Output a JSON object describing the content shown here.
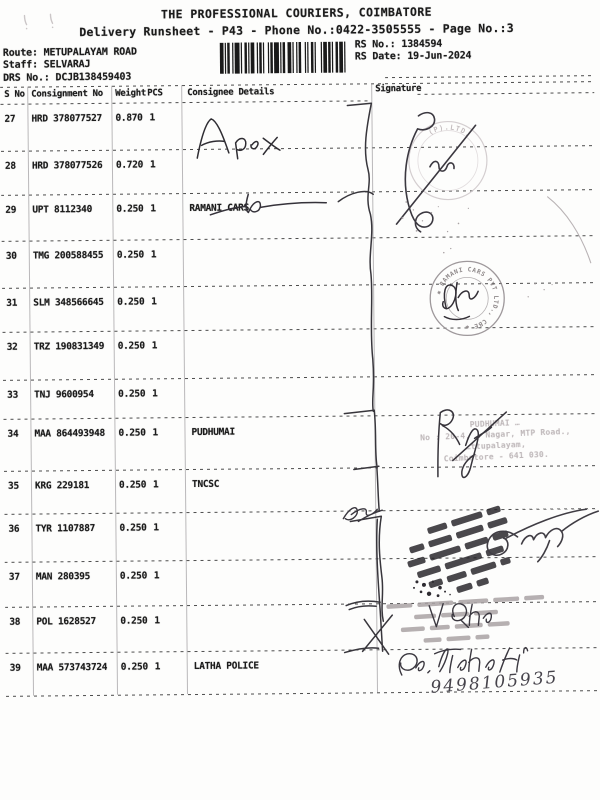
{
  "doc": {
    "title": "THE PROFESSIONAL COURIERS, COIMBATORE",
    "subtitle": "Delivery Runsheet - P43 - Phone No.:0422-3505555 - Page No.:3",
    "route_label": "Route:",
    "route_value": "METUPALAYAM ROAD",
    "staff_label": "Staff:",
    "staff_value": "SELVARAJ",
    "drs_label": "DRS No.:",
    "drs_value": "DCJB138459403",
    "rs_no_label": "RS No.:",
    "rs_no_value": "1384594",
    "rs_date_label": "RS Date:",
    "rs_date_value": "19-Jun-2024"
  },
  "table": {
    "headers": {
      "sno": "S No",
      "consignment": "Consignment No",
      "weight": "Weight",
      "pcs": "PCS",
      "consignee": "Consignee Details",
      "signature": "Signature"
    },
    "rows": [
      {
        "sno": "27",
        "consignment": "HRD 378077527",
        "weight": "0.870",
        "pcs": "1",
        "consignee": ""
      },
      {
        "sno": "28",
        "consignment": "HRD 378077526",
        "weight": "0.720",
        "pcs": "1",
        "consignee": ""
      },
      {
        "sno": "29",
        "consignment": "UPT 8112340",
        "weight": "0.250",
        "pcs": "1",
        "consignee": "RAMANI CARS"
      },
      {
        "sno": "30",
        "consignment": "TMG 200588455",
        "weight": "0.250",
        "pcs": "1",
        "consignee": ""
      },
      {
        "sno": "31",
        "consignment": "SLM 348566645",
        "weight": "0.250",
        "pcs": "1",
        "consignee": ""
      },
      {
        "sno": "32",
        "consignment": "TRZ 190831349",
        "weight": "0.250",
        "pcs": "1",
        "consignee": ""
      },
      {
        "sno": "33",
        "consignment": "TNJ 9600954",
        "weight": "0.250",
        "pcs": "1",
        "consignee": ""
      },
      {
        "sno": "34",
        "consignment": "MAA 864493948",
        "weight": "0.250",
        "pcs": "1",
        "consignee": "PUDHUMAI"
      },
      {
        "sno": "35",
        "consignment": "KRG 229181",
        "weight": "0.250",
        "pcs": "1",
        "consignee": "TNCSC"
      },
      {
        "sno": "36",
        "consignment": "TYR 1107887",
        "weight": "0.250",
        "pcs": "1",
        "consignee": ""
      },
      {
        "sno": "37",
        "consignment": "MAN 280395",
        "weight": "0.250",
        "pcs": "1",
        "consignee": ""
      },
      {
        "sno": "38",
        "consignment": "POL 1628527",
        "weight": "0.250",
        "pcs": "1",
        "consignee": ""
      },
      {
        "sno": "39",
        "consignment": "MAA 573743724",
        "weight": "0.250",
        "pcs": "1",
        "consignee": "LATHA POLICE"
      }
    ]
  },
  "stamps": {
    "courier_arc": "(P).LTD.",
    "ramani_arc": "✱ RAMANI CARS PVT LTD., CBE ✱",
    "pudhumai_lines": [
      "PUDHUMAI …",
      "No : 20-4, … Nagar, MTP Road.,",
      "…ttupalayam,",
      "Coimbatore - 641 030."
    ]
  },
  "handwriting": {
    "row27_note": "Apex",
    "row28_note": "do",
    "row27_signature": "signature scrawl",
    "ramani_signature": "signature scrawl",
    "row34_signature": "signature scrawl",
    "row36_mark": "scribble",
    "row37_signature": "signature scrawl",
    "row38_signature": "signature scrawl",
    "row39_signature": "signature scrawl",
    "row39_phone": "9498105935"
  },
  "colors": {
    "ink": "#1c1c1c",
    "dash": "#2d2d2d",
    "stamp_light": "#c6bfc1",
    "stamp_mid": "#8e8889",
    "handwriting": "#3b3840"
  }
}
